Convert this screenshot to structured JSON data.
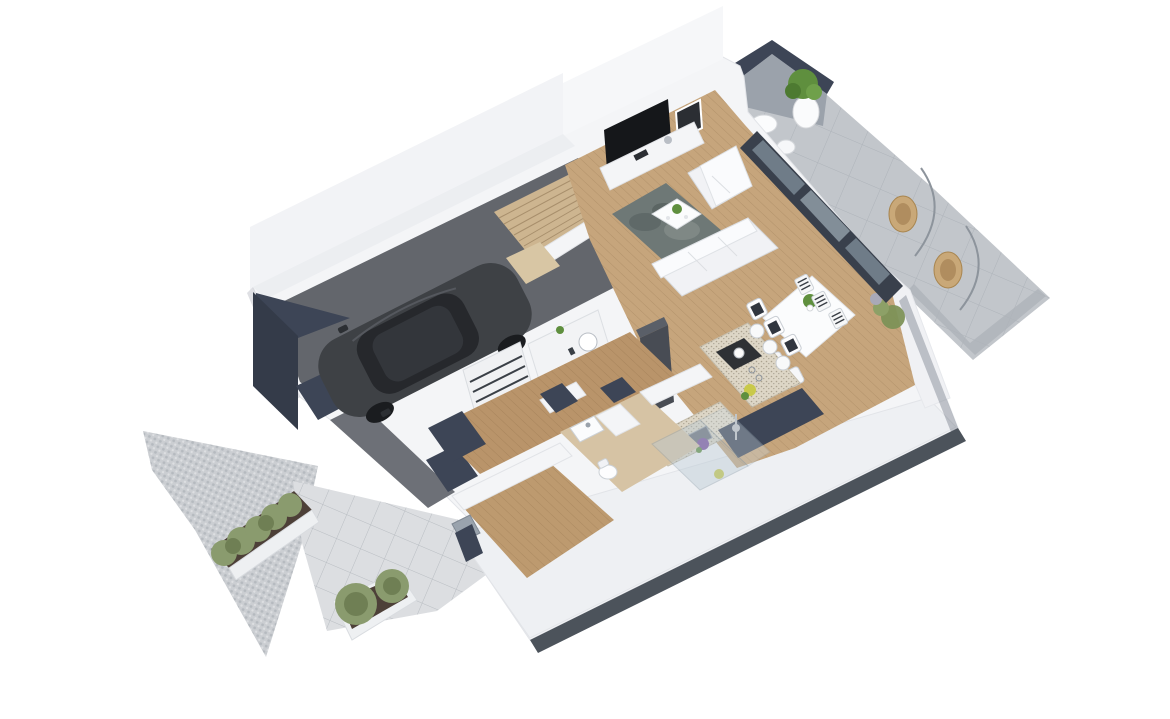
{
  "meta": {
    "description": "3D isometric render of a house ground-floor plan, no visible text labels"
  },
  "palette": {
    "background": "#ffffff",
    "wall_white": "#f4f5f7",
    "wall_band": "#eef0f3",
    "wall_shade": "#e8eaee",
    "wall_edge": "#e2e4e8",
    "navy_accent": "#3d4556",
    "navy_dark": "#343b49",
    "concrete": "#c2c6cb",
    "concrete_dark": "#aeb3b9",
    "cobble": "#cbced2",
    "walkway": "#dcdee1",
    "wood": "#c6a57c",
    "wood_dark": "#b9946a",
    "wood_light": "#d6c3a4",
    "stairs_wood": "#cdb590",
    "garage_floor": "#63666c",
    "ramp": "#6d7077",
    "car_body": "#3e4145",
    "car_glass": "#26282c",
    "rug": "#6e7876",
    "glass_frame": "#39404c",
    "glass_pane": "#76838f",
    "sofa": "#f1f2f5",
    "furniture_white": "#fbfcfd",
    "counter_speckle": "#ddd6c6",
    "cooktop": "#2e3135",
    "appliance_dark": "#484c54",
    "plant_green": "#5f8f3e",
    "shrub_olive": "#8a9b6e",
    "shrub_dark": "#6f7f54",
    "soil": "#4d4038",
    "shadow": "#394049",
    "wicker": "#c9a878",
    "metal": "#9aa2ab",
    "flower_yellow": "#c9c94a",
    "flower_purple": "#7a4f9e"
  },
  "scene": {
    "view": "isometric-3d-floorplan-render",
    "rooms": [
      "garage",
      "staircase",
      "living-room",
      "dining-area",
      "kitchen",
      "hallway",
      "bathroom",
      "utility-area",
      "terrace",
      "driveway",
      "walkway"
    ],
    "objects": [
      "car",
      "corner-sofa-set",
      "rug",
      "coffee-table",
      "tv-media-wall",
      "framed-picture",
      "dining-table",
      "dining-chairs",
      "kitchen-island",
      "bar-stools",
      "tall-fridge",
      "sink-counter",
      "shelving-cabinet",
      "shower-enclosure",
      "toilet",
      "wash-basin",
      "potted-plant",
      "hedge-planters",
      "shrub-planter",
      "hanging-wicker-chairs",
      "terrace-table-set",
      "wooden-stairs",
      "sliding-glass-doors",
      "entry-door"
    ]
  }
}
